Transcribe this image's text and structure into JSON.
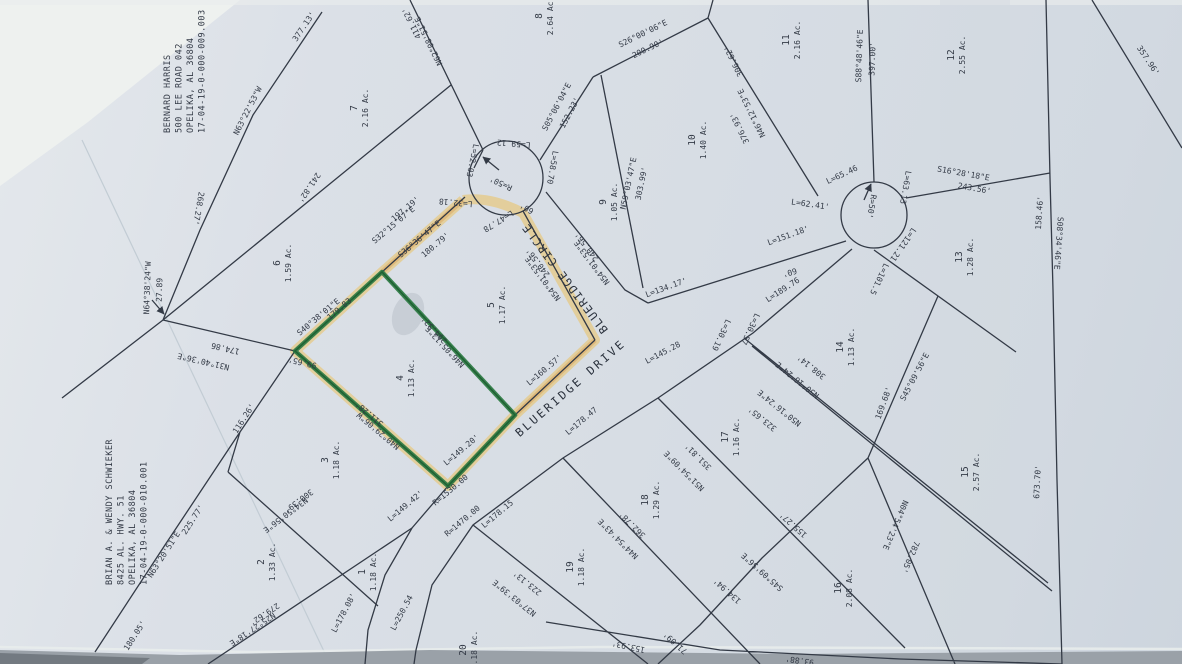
{
  "document": {
    "kind": "scanned subdivision plat / survey map",
    "highlighted_lot": "4"
  },
  "colors": {
    "ink": "#333a46",
    "paper": "#dadfe6",
    "marker_green": "#2b7a42",
    "highlighter_yellow": "#e7c87e",
    "highlighter_orange": "#d9a054",
    "scanner_gray": "#9aa1a8"
  },
  "owners": [
    {
      "lines": [
        "BERNARD HARRIS",
        "500 LEE ROAD 042",
        "OPELIKA, AL 36804",
        "17-04-19-0-000-009.003"
      ],
      "x": 170,
      "y": 133
    },
    {
      "lines": [
        "BRIAN A. & WENDY SCHWIEKER",
        "8425 AL. HWY. 51",
        "OPELIKA, AL 36804",
        "17-04-19-0-000-010.001"
      ],
      "x": 112,
      "y": 585
    }
  ],
  "streets": [
    {
      "label": "BLUERIDGE CIRCLE",
      "x": 568,
      "y": 276,
      "r": -127,
      "ls": 1.5
    },
    {
      "label": "BLUERIDGE DRIVE",
      "x": 573,
      "y": 391,
      "r": -41,
      "ls": 2.5
    }
  ],
  "lots": [
    {
      "n": "7",
      "a": "2.16 Ac.",
      "x": 360,
      "y": 108
    },
    {
      "n": "8",
      "a": "2.64 Ac.",
      "x": 545,
      "y": 16
    },
    {
      "n": "11",
      "a": "2.16 Ac.",
      "x": 792,
      "y": 40
    },
    {
      "n": "12",
      "a": "2.55 Ac.",
      "x": 957,
      "y": 55
    },
    {
      "n": "10",
      "a": "1.40 Ac.",
      "x": 698,
      "y": 140
    },
    {
      "n": "9",
      "a": "1.05 Ac.",
      "x": 609,
      "y": 202
    },
    {
      "n": "6",
      "a": "1.59 Ac.",
      "x": 283,
      "y": 263
    },
    {
      "n": "5",
      "a": "1.17 Ac.",
      "x": 497,
      "y": 305
    },
    {
      "n": "13",
      "a": "1.28 Ac.",
      "x": 965,
      "y": 257
    },
    {
      "n": "4",
      "a": "1.13 Ac.",
      "x": 406,
      "y": 378
    },
    {
      "n": "14",
      "a": "1.13 Ac.",
      "x": 846,
      "y": 347
    },
    {
      "n": "3",
      "a": "1.18 Ac.",
      "x": 331,
      "y": 460
    },
    {
      "n": "17",
      "a": "1.16 Ac.",
      "x": 731,
      "y": 437
    },
    {
      "n": "18",
      "a": "1.29 Ac.",
      "x": 651,
      "y": 500
    },
    {
      "n": "15",
      "a": "2.57 Ac.",
      "x": 971,
      "y": 472
    },
    {
      "n": "19",
      "a": "1.18 Ac.",
      "x": 576,
      "y": 567
    },
    {
      "n": "2",
      "a": "1.33 Ac.",
      "x": 267,
      "y": 562
    },
    {
      "n": "16",
      "a": "2.08 Ac.",
      "x": 844,
      "y": 588
    },
    {
      "n": "1",
      "a": "1.18 Ac.",
      "x": 368,
      "y": 572
    },
    {
      "n": "20",
      "a": "1.18 Ac.",
      "x": 469,
      "y": 650
    }
  ],
  "bearings": [
    {
      "t": "377.13'",
      "x": 306,
      "y": 28,
      "r": -56
    },
    {
      "t": "N63°22'53\"W",
      "x": 250,
      "y": 112,
      "r": -63
    },
    {
      "t": "268.27'",
      "x": 196,
      "y": 208,
      "r": 100
    },
    {
      "t": "N64°38'24\"W",
      "x": 150,
      "y": 288,
      "r": -88
    },
    {
      "t": "27.89",
      "x": 162,
      "y": 290,
      "r": -88
    },
    {
      "t": "N31°40'36\"E",
      "x": 204,
      "y": 359,
      "r": 193
    },
    {
      "t": "174.86",
      "x": 226,
      "y": 346,
      "r": 193
    },
    {
      "t": "99.65'",
      "x": 303,
      "y": 360,
      "r": 193
    },
    {
      "t": "116.26'",
      "x": 246,
      "y": 420,
      "r": -57
    },
    {
      "t": "N63°20'51\"E",
      "x": 166,
      "y": 556,
      "r": -57
    },
    {
      "t": "225.77'",
      "x": 195,
      "y": 521,
      "r": -57
    },
    {
      "t": "180.05'",
      "x": 137,
      "y": 637,
      "r": -57
    },
    {
      "t": "N25°27'18\"E",
      "x": 251,
      "y": 627,
      "r": 146
    },
    {
      "t": "279.62'",
      "x": 263,
      "y": 612,
      "r": 146
    },
    {
      "t": "N34°50'56\"E",
      "x": 284,
      "y": 513,
      "r": 143
    },
    {
      "t": "300.39'",
      "x": 297,
      "y": 499,
      "r": 143
    },
    {
      "t": "241.82'",
      "x": 307,
      "y": 186,
      "r": 124
    },
    {
      "t": "N62°08'51\"E",
      "x": 431,
      "y": 40,
      "r": 244
    },
    {
      "t": "411.62'",
      "x": 414,
      "y": 22,
      "r": 244
    },
    {
      "t": "197.19'",
      "x": 407,
      "y": 211,
      "r": -40
    },
    {
      "t": "S32°15'07\"E",
      "x": 395,
      "y": 227,
      "r": -40
    },
    {
      "t": "S36°36'47\"E",
      "x": 421,
      "y": 241,
      "r": -40
    },
    {
      "t": "180.79'",
      "x": 437,
      "y": 247,
      "r": -40
    },
    {
      "t": "S40°38'01\"E",
      "x": 320,
      "y": 319,
      "r": -40
    },
    {
      "t": "179.83",
      "x": 341,
      "y": 311,
      "r": -40
    },
    {
      "t": "N46°05'12\"E",
      "x": 447,
      "y": 345,
      "r": 227
    },
    {
      "t": "294.32'",
      "x": 436,
      "y": 328,
      "r": 227
    },
    {
      "t": "N40°29'06\"W",
      "x": 380,
      "y": 429,
      "r": 220
    },
    {
      "t": "311.28'",
      "x": 371,
      "y": 412,
      "r": 220
    },
    {
      "t": "S26°00'06\"E",
      "x": 644,
      "y": 36,
      "r": -26
    },
    {
      "t": "200.90'",
      "x": 649,
      "y": 51,
      "r": -26
    },
    {
      "t": "S05°06'04\"E",
      "x": 559,
      "y": 108,
      "r": -62
    },
    {
      "t": "152.23'",
      "x": 572,
      "y": 114,
      "r": -62
    },
    {
      "t": "N46°12'53\"E",
      "x": 754,
      "y": 112,
      "r": 244
    },
    {
      "t": "376.93'",
      "x": 742,
      "y": 127,
      "r": 244
    },
    {
      "t": "306.62'",
      "x": 736,
      "y": 60,
      "r": 244
    },
    {
      "t": "S88°48'46\"E",
      "x": 862,
      "y": 56,
      "r": -88
    },
    {
      "t": "397.00'",
      "x": 875,
      "y": 59,
      "r": -88
    },
    {
      "t": "N59°03'47\"E",
      "x": 631,
      "y": 184,
      "r": -78
    },
    {
      "t": "303.99'",
      "x": 644,
      "y": 184,
      "r": -78
    },
    {
      "t": "357.96'",
      "x": 1146,
      "y": 62,
      "r": 56
    },
    {
      "t": "S16°28'18\"E",
      "x": 963,
      "y": 176,
      "r": 10
    },
    {
      "t": "243.56'",
      "x": 974,
      "y": 191,
      "r": 10
    },
    {
      "t": "158.46'",
      "x": 1042,
      "y": 213,
      "r": -86
    },
    {
      "t": "S08°34'46\"E",
      "x": 1056,
      "y": 243,
      "r": 94
    },
    {
      "t": "673.70'",
      "x": 1040,
      "y": 482,
      "r": -87
    },
    {
      "t": "L=59.12",
      "x": 514,
      "y": 141,
      "r": 185
    },
    {
      "t": "L=52.03",
      "x": 470,
      "y": 160,
      "r": 102
    },
    {
      "t": "R=50'",
      "x": 502,
      "y": 181,
      "r": 205
    },
    {
      "t": "L=58.70",
      "x": 550,
      "y": 167,
      "r": 100
    },
    {
      "t": "L=32.18",
      "x": 456,
      "y": 200,
      "r": 185
    },
    {
      "t": "L=47.78",
      "x": 497,
      "y": 219,
      "r": 148
    },
    {
      "t": "60'",
      "x": 528,
      "y": 206,
      "r": 210
    },
    {
      "t": "240.56'",
      "x": 540,
      "y": 261,
      "r": 233
    },
    {
      "t": "N54°01'53\"E",
      "x": 545,
      "y": 277,
      "r": 233
    },
    {
      "t": "240.56'",
      "x": 589,
      "y": 245,
      "r": 233
    },
    {
      "t": "N54°01'53\"E",
      "x": 594,
      "y": 261,
      "r": 233
    },
    {
      "t": "L=65.46",
      "x": 843,
      "y": 177,
      "r": -25
    },
    {
      "t": "L=62.41'",
      "x": 810,
      "y": 207,
      "r": 8
    },
    {
      "t": "L=63.13",
      "x": 903,
      "y": 187,
      "r": 100
    },
    {
      "t": "R=50'",
      "x": 869,
      "y": 206,
      "r": 100
    },
    {
      "t": "L=121.21",
      "x": 901,
      "y": 243,
      "r": 125
    },
    {
      "t": "L=101.5",
      "x": 877,
      "y": 278,
      "r": 115
    },
    {
      "t": "L=151.18'",
      "x": 789,
      "y": 238,
      "r": -20
    },
    {
      "t": "L=134.17'",
      "x": 667,
      "y": 290,
      "r": -20
    },
    {
      "t": "L=189.76",
      "x": 784,
      "y": 292,
      "r": -33
    },
    {
      "t": "60'",
      "x": 789,
      "y": 270,
      "r": 163
    },
    {
      "t": "L=160.57'",
      "x": 546,
      "y": 372,
      "r": -40
    },
    {
      "t": "L=149.20'",
      "x": 463,
      "y": 452,
      "r": -40
    },
    {
      "t": "L=178.47",
      "x": 583,
      "y": 423,
      "r": -40
    },
    {
      "t": "L=145.28",
      "x": 664,
      "y": 355,
      "r": -28
    },
    {
      "t": "R=1530.00",
      "x": 452,
      "y": 492,
      "r": -40
    },
    {
      "t": "R=1470.00",
      "x": 464,
      "y": 523,
      "r": -40
    },
    {
      "t": "L=149.42'",
      "x": 407,
      "y": 508,
      "r": -40
    },
    {
      "t": "L=178.15",
      "x": 499,
      "y": 516,
      "r": -40
    },
    {
      "t": "L=250.54",
      "x": 404,
      "y": 614,
      "r": -62
    },
    {
      "t": "L=178.08'",
      "x": 346,
      "y": 614,
      "r": -62
    },
    {
      "t": "L=30.57",
      "x": 748,
      "y": 328,
      "r": 115
    },
    {
      "t": "L=30.19",
      "x": 719,
      "y": 334,
      "r": 115
    },
    {
      "t": "N50°16'24\"E",
      "x": 799,
      "y": 378,
      "r": 219
    },
    {
      "t": "308.14'",
      "x": 813,
      "y": 365,
      "r": 219
    },
    {
      "t": "N50°16'24\"E",
      "x": 781,
      "y": 406,
      "r": 219
    },
    {
      "t": "323.65'",
      "x": 764,
      "y": 417,
      "r": 219
    },
    {
      "t": "N51°54'09\"E",
      "x": 686,
      "y": 469,
      "r": 225
    },
    {
      "t": "351.81'",
      "x": 700,
      "y": 455,
      "r": 225
    },
    {
      "t": "N44°54'43\"E",
      "x": 620,
      "y": 537,
      "r": 225
    },
    {
      "t": "362.78'",
      "x": 634,
      "y": 523,
      "r": 225
    },
    {
      "t": "N37°03'39\"E",
      "x": 516,
      "y": 596,
      "r": 219
    },
    {
      "t": "223.13'",
      "x": 529,
      "y": 581,
      "r": 219
    },
    {
      "t": "155.27'",
      "x": 795,
      "y": 523,
      "r": 222
    },
    {
      "t": "S45°09'56\"E",
      "x": 764,
      "y": 570,
      "r": 222
    },
    {
      "t": "134.94'",
      "x": 729,
      "y": 589,
      "r": 222
    },
    {
      "t": "71.09'",
      "x": 677,
      "y": 641,
      "r": 222
    },
    {
      "t": "153.93'",
      "x": 629,
      "y": 644,
      "r": 192
    },
    {
      "t": "93.88'",
      "x": 800,
      "y": 658,
      "r": 188
    },
    {
      "t": "169.68'",
      "x": 886,
      "y": 404,
      "r": -70
    },
    {
      "t": "S45°09'56\"E",
      "x": 917,
      "y": 378,
      "r": -62
    },
    {
      "t": "N04°54'23\"E",
      "x": 893,
      "y": 524,
      "r": 113
    },
    {
      "t": "782.05'",
      "x": 908,
      "y": 556,
      "r": 113
    }
  ]
}
